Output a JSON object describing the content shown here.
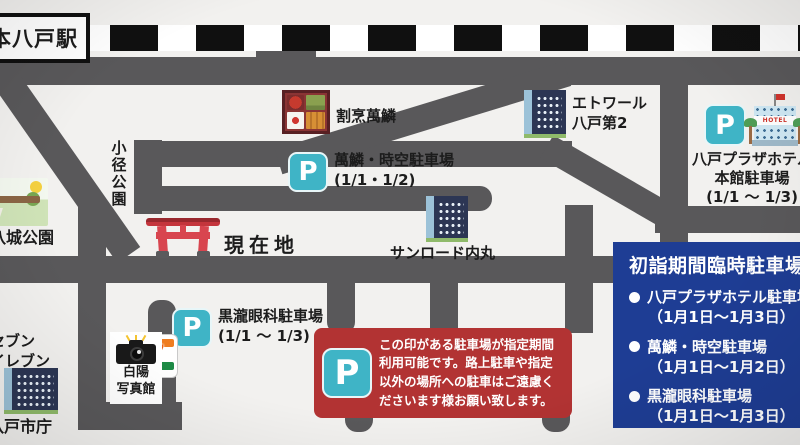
{
  "colors": {
    "road": "#59585a",
    "rail_black": "#101010",
    "parking_teal": "#3fb4c6",
    "notice_red": "#b23333",
    "legend_blue": "#1e3d94",
    "torii_red": "#d8454f",
    "background": "#f2f1ef"
  },
  "station": {
    "name": "本八戸駅"
  },
  "p_mark": "P",
  "places": {
    "kappou": "割烹萬鱗",
    "etoile_line1": "エトワール",
    "etoile_line2": "八戸第2",
    "sunroad": "サンロード内丸",
    "komichi_park": "小径公園",
    "miyagi_park": "三八城公園",
    "current_location": "現在地",
    "seven_line1": "セブン",
    "seven_line2": "イレブン",
    "seven_digit": "7",
    "hakuyo_line1": "白陽",
    "hakuyo_line2": "写真館",
    "city_hall": "八戸市庁",
    "hotel_sign": "HOTEL"
  },
  "parkings": {
    "banrin": {
      "name": "萬鱗・時空駐車場",
      "dates": "(1/1・1/2)"
    },
    "plaza": {
      "name": "八戸プラザホテル",
      "name2": "本館駐車場",
      "dates": "(1/1 〜 1/3)"
    },
    "kurotaki": {
      "name": "黒瀧眼科駐車場",
      "dates": "(1/1 〜 1/3)"
    }
  },
  "notice": {
    "line1": "この印がある駐車場が指定期間",
    "line2": "利用可能です。路上駐車や指定",
    "line3": "以外の場所への駐車はご遠慮く",
    "line4": "ださいます様お願い致します。"
  },
  "legend": {
    "title": "初詣期間臨時駐車場",
    "items": [
      {
        "name": "八戸プラザホテル駐車場",
        "dates": "（1月1日〜1月3日）"
      },
      {
        "name": "萬鱗・時空駐車場",
        "dates": "（1月1日〜1月2日）"
      },
      {
        "name": "黒瀧眼科駐車場",
        "dates": "（1月1日〜1月3日）"
      }
    ]
  }
}
